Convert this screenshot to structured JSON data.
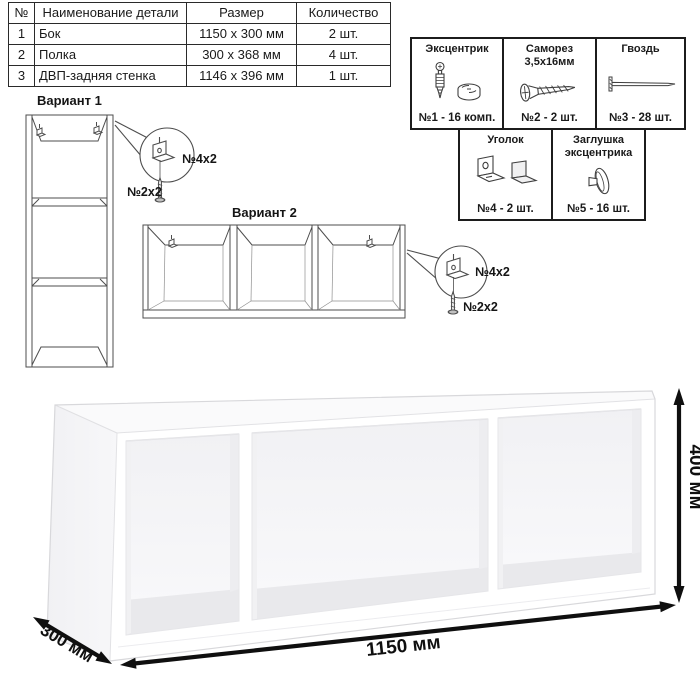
{
  "parts_table": {
    "headers": [
      "№",
      "Наименование детали",
      "Размер",
      "Количество"
    ],
    "rows": [
      {
        "num": "1",
        "name": "Бок",
        "size": "1150 x 300 мм",
        "qty": "2 шт."
      },
      {
        "num": "2",
        "name": "Полка",
        "size": "300 x 368 мм",
        "qty": "4 шт."
      },
      {
        "num": "3",
        "name": "ДВП-задняя стенка",
        "size": "1146 x 396 мм",
        "qty": "1 шт."
      }
    ]
  },
  "hardware": {
    "items": [
      {
        "label": "Эксцентрик",
        "count": "№1 - 16 комп.",
        "icon": "minifix-cam-icon"
      },
      {
        "label": "Саморез 3,5х16мм",
        "count": "№2 - 2 шт.",
        "icon": "screw-icon"
      },
      {
        "label": "Гвоздь",
        "count": "№3 - 28 шт.",
        "icon": "nail-icon"
      },
      {
        "label": "Уголок",
        "count": "№4 - 2 шт.",
        "icon": "corner-bracket-icon"
      },
      {
        "label": "Заглушка эксцентрика",
        "count": "№5 - 16 шт.",
        "icon": "cam-cap-icon"
      }
    ]
  },
  "variants": {
    "variant1": {
      "title": "Вариант 1",
      "bracket_label": "№4х2",
      "screw_label": "№2х2"
    },
    "variant2": {
      "title": "Вариант 2",
      "bracket_label": "№4х2",
      "screw_label": "№2х2"
    }
  },
  "dimensions": {
    "width": "1150 мм",
    "height": "400 мм",
    "depth": "300 мм"
  },
  "colors": {
    "text": "#1a1a1a",
    "line_art": "#4a4a4a",
    "dimension_arrows": "#111111",
    "table_border": "#2a2a2a"
  }
}
